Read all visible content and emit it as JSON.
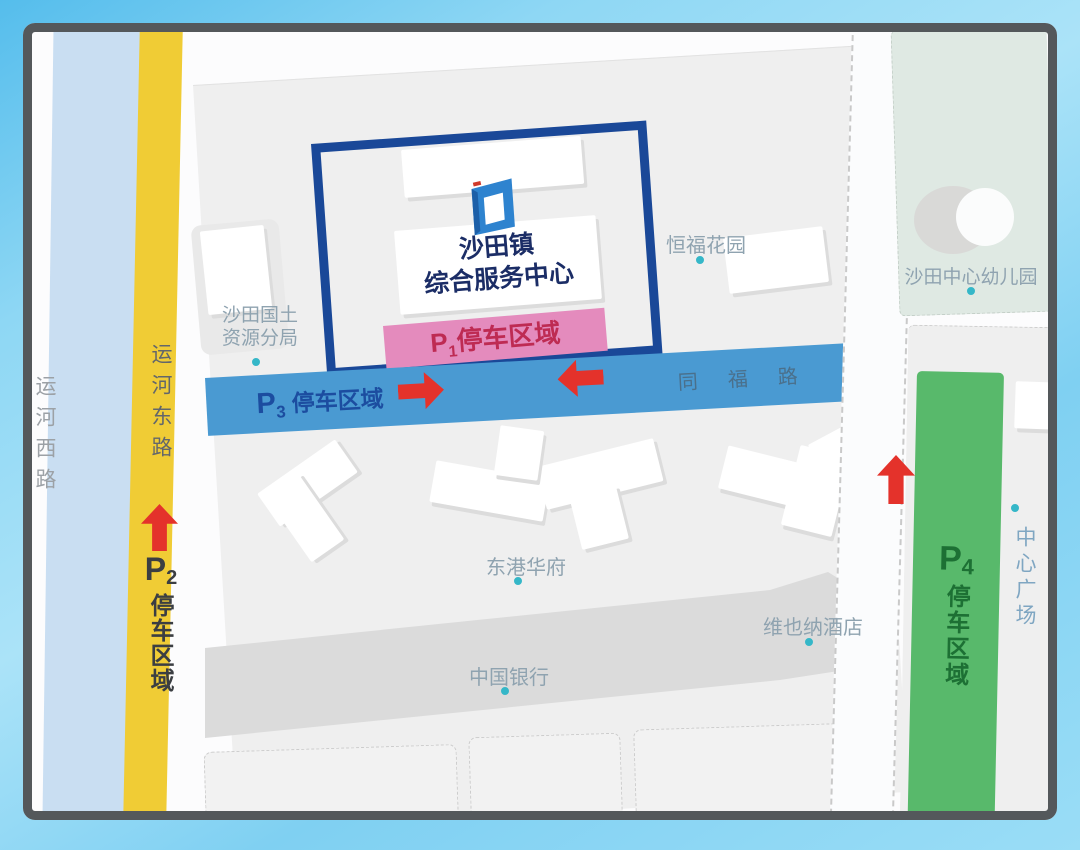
{
  "colors": {
    "sky": "#7ecdf0",
    "frame_border": "#54585b",
    "map_bg": "#fcfcfd",
    "block_gray": "#efefef",
    "walkway_gray": "#dbdbdb",
    "canal_blue": "#c9def2",
    "road_yellow": "#f0cc35",
    "road_blue": "#4a9ad2",
    "parking_pink": "#e48bbd",
    "parking_green": "#58b96b",
    "boundary_navy": "#1a4898",
    "title_navy": "#1b2d66",
    "p1_text": "#be2b53",
    "p2_text": "#3b3e42",
    "p3_text": "#1c4da0",
    "p4_text": "#1d7034",
    "arrow_red": "#e4322b",
    "marker_teal": "#35b7c8",
    "poi_label": "#8fa3b0",
    "road_label_gray": "#9ca1a6",
    "tongfu_text": "#4a708c",
    "plaza_text": "#7fa6c2",
    "kindergarten_bg": "#dfe9e3"
  },
  "center": {
    "title_line1": "沙田镇",
    "title_line2": "综合服务中心"
  },
  "roads": {
    "yunhe_west": "运河西路",
    "yunhe_east": "运河东路",
    "tongfu": "同福路"
  },
  "parking": {
    "p1": {
      "letter": "P",
      "digit": "1",
      "label": "停车区域"
    },
    "p2": {
      "letter": "P",
      "digit": "2",
      "label": "停车区域"
    },
    "p3": {
      "letter": "P",
      "digit": "3",
      "label": "停车区域"
    },
    "p4": {
      "letter": "P",
      "digit": "4",
      "label": "停车区域"
    }
  },
  "pois": {
    "land_bureau_line1": "沙田国土",
    "land_bureau_line2": "资源分局",
    "hengfu_garden": "恒福花园",
    "kindergarten": "沙田中心幼儿园",
    "donggang": "东港华府",
    "vienna_hotel": "维也纳酒店",
    "bank_of_china": "中国银行",
    "central_plaza": "中心广场"
  }
}
